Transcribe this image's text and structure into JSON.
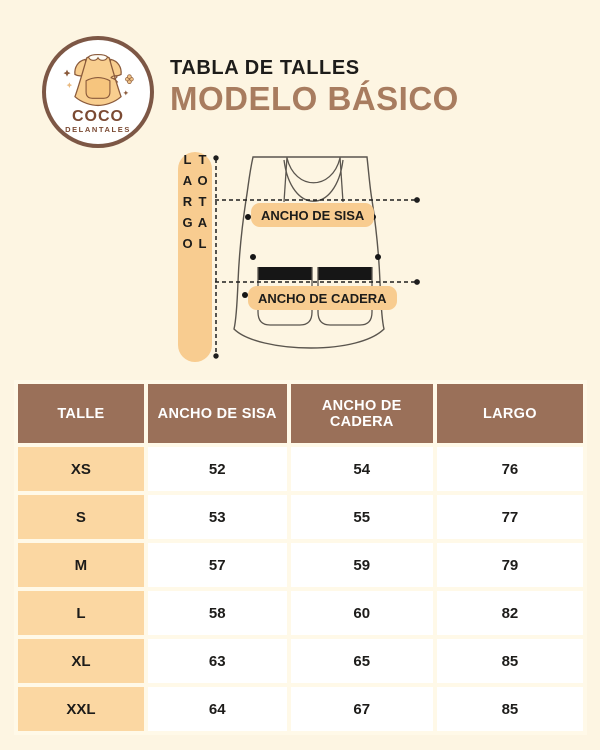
{
  "brand": {
    "name_top": "COCO",
    "name_bottom": "DELANTALES"
  },
  "header": {
    "subtitle": "TABLA DE TALLES",
    "title": "MODELO BÁSICO"
  },
  "diagram": {
    "largo_label": "LARGO TOTAL",
    "sisa_label": "ANCHO DE SISA",
    "cadera_label": "ANCHO DE CADERA"
  },
  "table": {
    "columns": [
      "TALLE",
      "ANCHO DE SISA",
      "ANCHO DE CADERA",
      "LARGO"
    ],
    "rows": [
      [
        "XS",
        "52",
        "54",
        "76"
      ],
      [
        "S",
        "53",
        "55",
        "77"
      ],
      [
        "M",
        "57",
        "59",
        "79"
      ],
      [
        "L",
        "58",
        "60",
        "82"
      ],
      [
        "XL",
        "63",
        "65",
        "85"
      ],
      [
        "XXL",
        "64",
        "67",
        "85"
      ]
    ]
  },
  "chart_data": {
    "type": "table",
    "title": "TABLA DE TALLES — MODELO BÁSICO",
    "columns": [
      "TALLE",
      "ANCHO DE SISA",
      "ANCHO DE CADERA",
      "LARGO"
    ],
    "rows": [
      {
        "talle": "XS",
        "ancho_de_sisa": 52,
        "ancho_de_cadera": 54,
        "largo": 76
      },
      {
        "talle": "S",
        "ancho_de_sisa": 53,
        "ancho_de_cadera": 55,
        "largo": 77
      },
      {
        "talle": "M",
        "ancho_de_sisa": 57,
        "ancho_de_cadera": 59,
        "largo": 79
      },
      {
        "talle": "L",
        "ancho_de_sisa": 58,
        "ancho_de_cadera": 60,
        "largo": 82
      },
      {
        "talle": "XL",
        "ancho_de_sisa": 63,
        "ancho_de_cadera": 65,
        "largo": 85
      },
      {
        "talle": "XXL",
        "ancho_de_sisa": 64,
        "ancho_de_cadera": 67,
        "largo": 85
      }
    ]
  },
  "colors": {
    "background": "#FDF5E2",
    "header_brown": "#9A7059",
    "title_brown": "#A87C5F",
    "logo_brown": "#7B4A33",
    "pill_orange": "#F8CC90",
    "row_orange": "#FBD7A2",
    "text_black": "#1D1C1A"
  }
}
